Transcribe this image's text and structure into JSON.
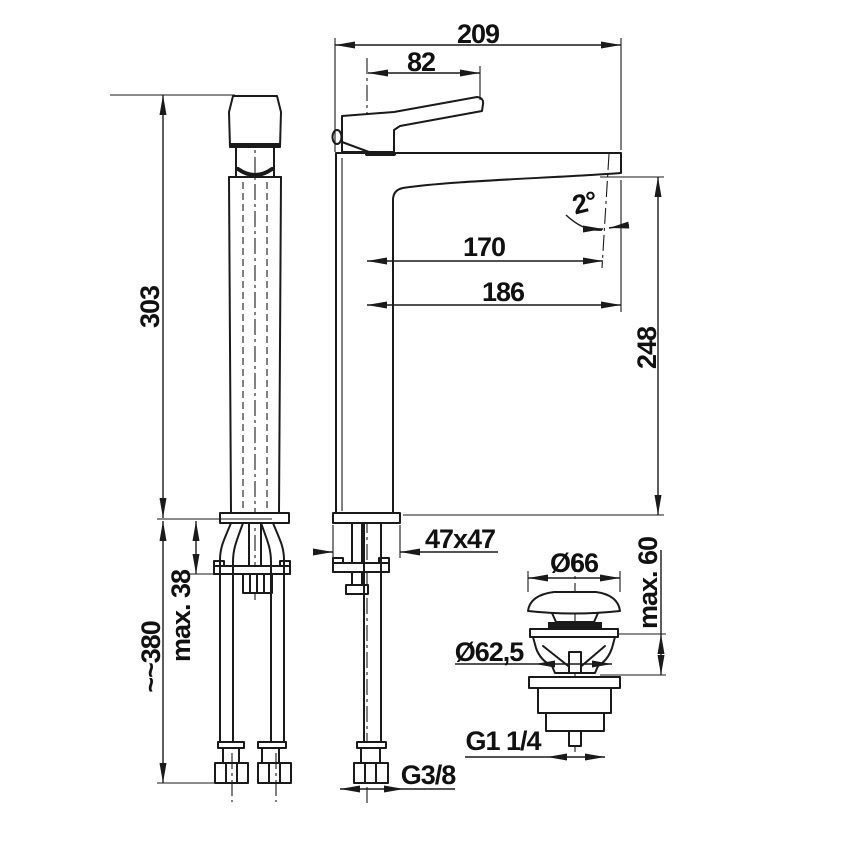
{
  "title": "Washbasin tap technical drawing",
  "colors": {
    "line": "#1a1a1a",
    "background": "#ffffff"
  },
  "dimensions": {
    "overall_length": "209",
    "lever_length": "82",
    "body_height": "303",
    "mounting_max_thickness": "max. 38",
    "hose_length": "~~380",
    "spout_reach_to_axis": "170",
    "spout_reach_overall": "186",
    "outlet_angle": "2°",
    "outlet_height": "248",
    "base_cross_section": "47x47",
    "supply_thread": "G3/8",
    "plug_cap_diameter": "Ø66",
    "plug_clamp_max": "max. 60",
    "plug_body_diameter": "Ø62,5",
    "plug_thread": "G1 1/4"
  }
}
